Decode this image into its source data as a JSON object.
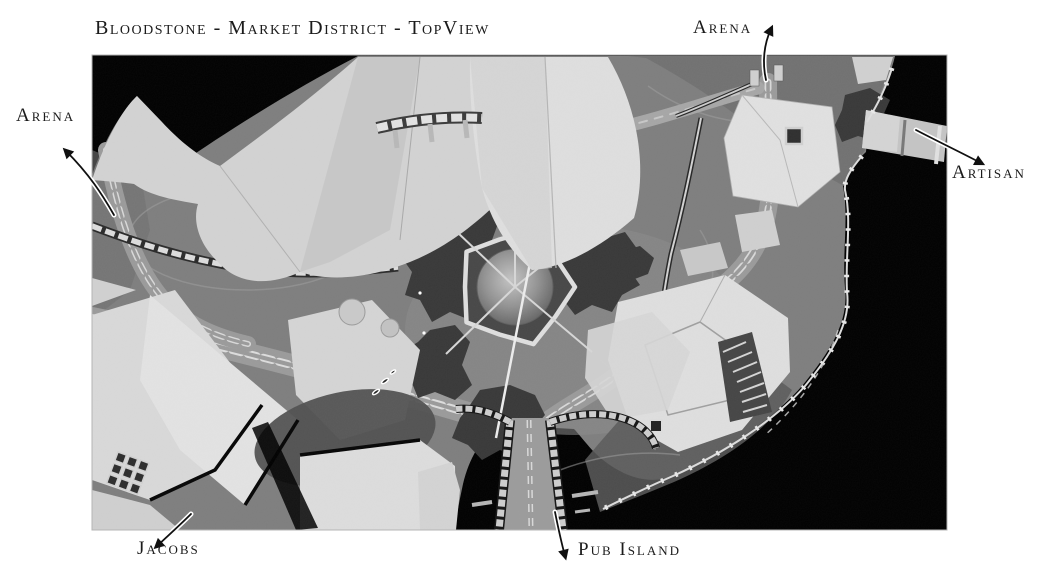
{
  "title": "Bloodstone - Market District - TopView",
  "labels": [
    {
      "id": "arena-top",
      "text": "Arena"
    },
    {
      "id": "arena-left",
      "text": "Arena"
    },
    {
      "id": "artisan",
      "text": "Artisan"
    },
    {
      "id": "jacobs",
      "text": "Jacobs"
    },
    {
      "id": "pub-island",
      "text": "Pub Island"
    }
  ],
  "colors": {
    "page_bg": "#ffffff",
    "ink": "#1b1b1b",
    "map_bg": "#000000",
    "terrain": "#7e7e7e",
    "roof": "#d9d9d9",
    "rock": "#383838",
    "road": "#9a9a9a",
    "wall": "#dcdcdc"
  }
}
